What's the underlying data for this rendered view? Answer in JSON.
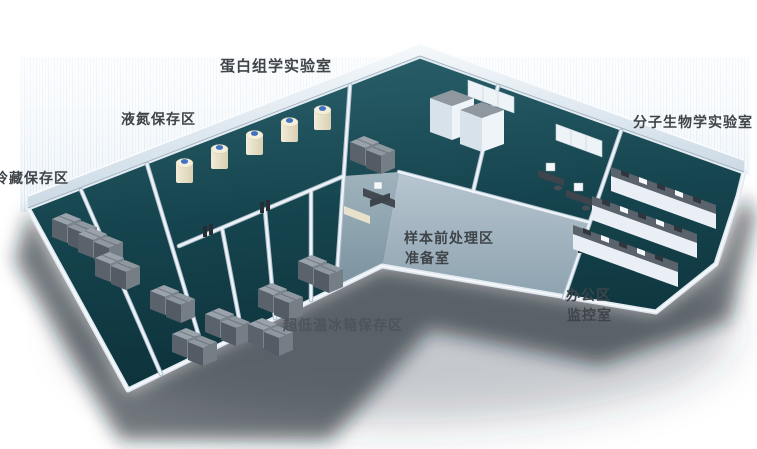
{
  "scene": {
    "type": "isometric-lab-floorplan",
    "background": "#ffffff"
  },
  "labels": {
    "proteomics_lab": "蛋白组学实验室",
    "liquid_nitrogen_storage": "液氮保存区",
    "cold_storage": "冷藏保存区",
    "molecular_biology_lab": "分子生物学实验室",
    "sample_pretreatment": "样本前处理区",
    "preparation_room": "准备室",
    "office_area": "办公区",
    "monitoring_room": "监控室",
    "ult_freezer_storage": "超低温冰箱保存区"
  },
  "palette": {
    "floor_teal": "#16454f",
    "corridor_floor": "#9fb2be",
    "wall_light": "#edf3f8",
    "wall_shade": "#c3d2de",
    "label_text": "#3f4449",
    "equipment_gray": "#9aa2ab",
    "equipment_dark": "#5a636c",
    "tank_body": "#ece5cf",
    "tank_cap": "#3f72c2",
    "shadow": "#1a212c",
    "haze_blue": "#bad2e6"
  }
}
